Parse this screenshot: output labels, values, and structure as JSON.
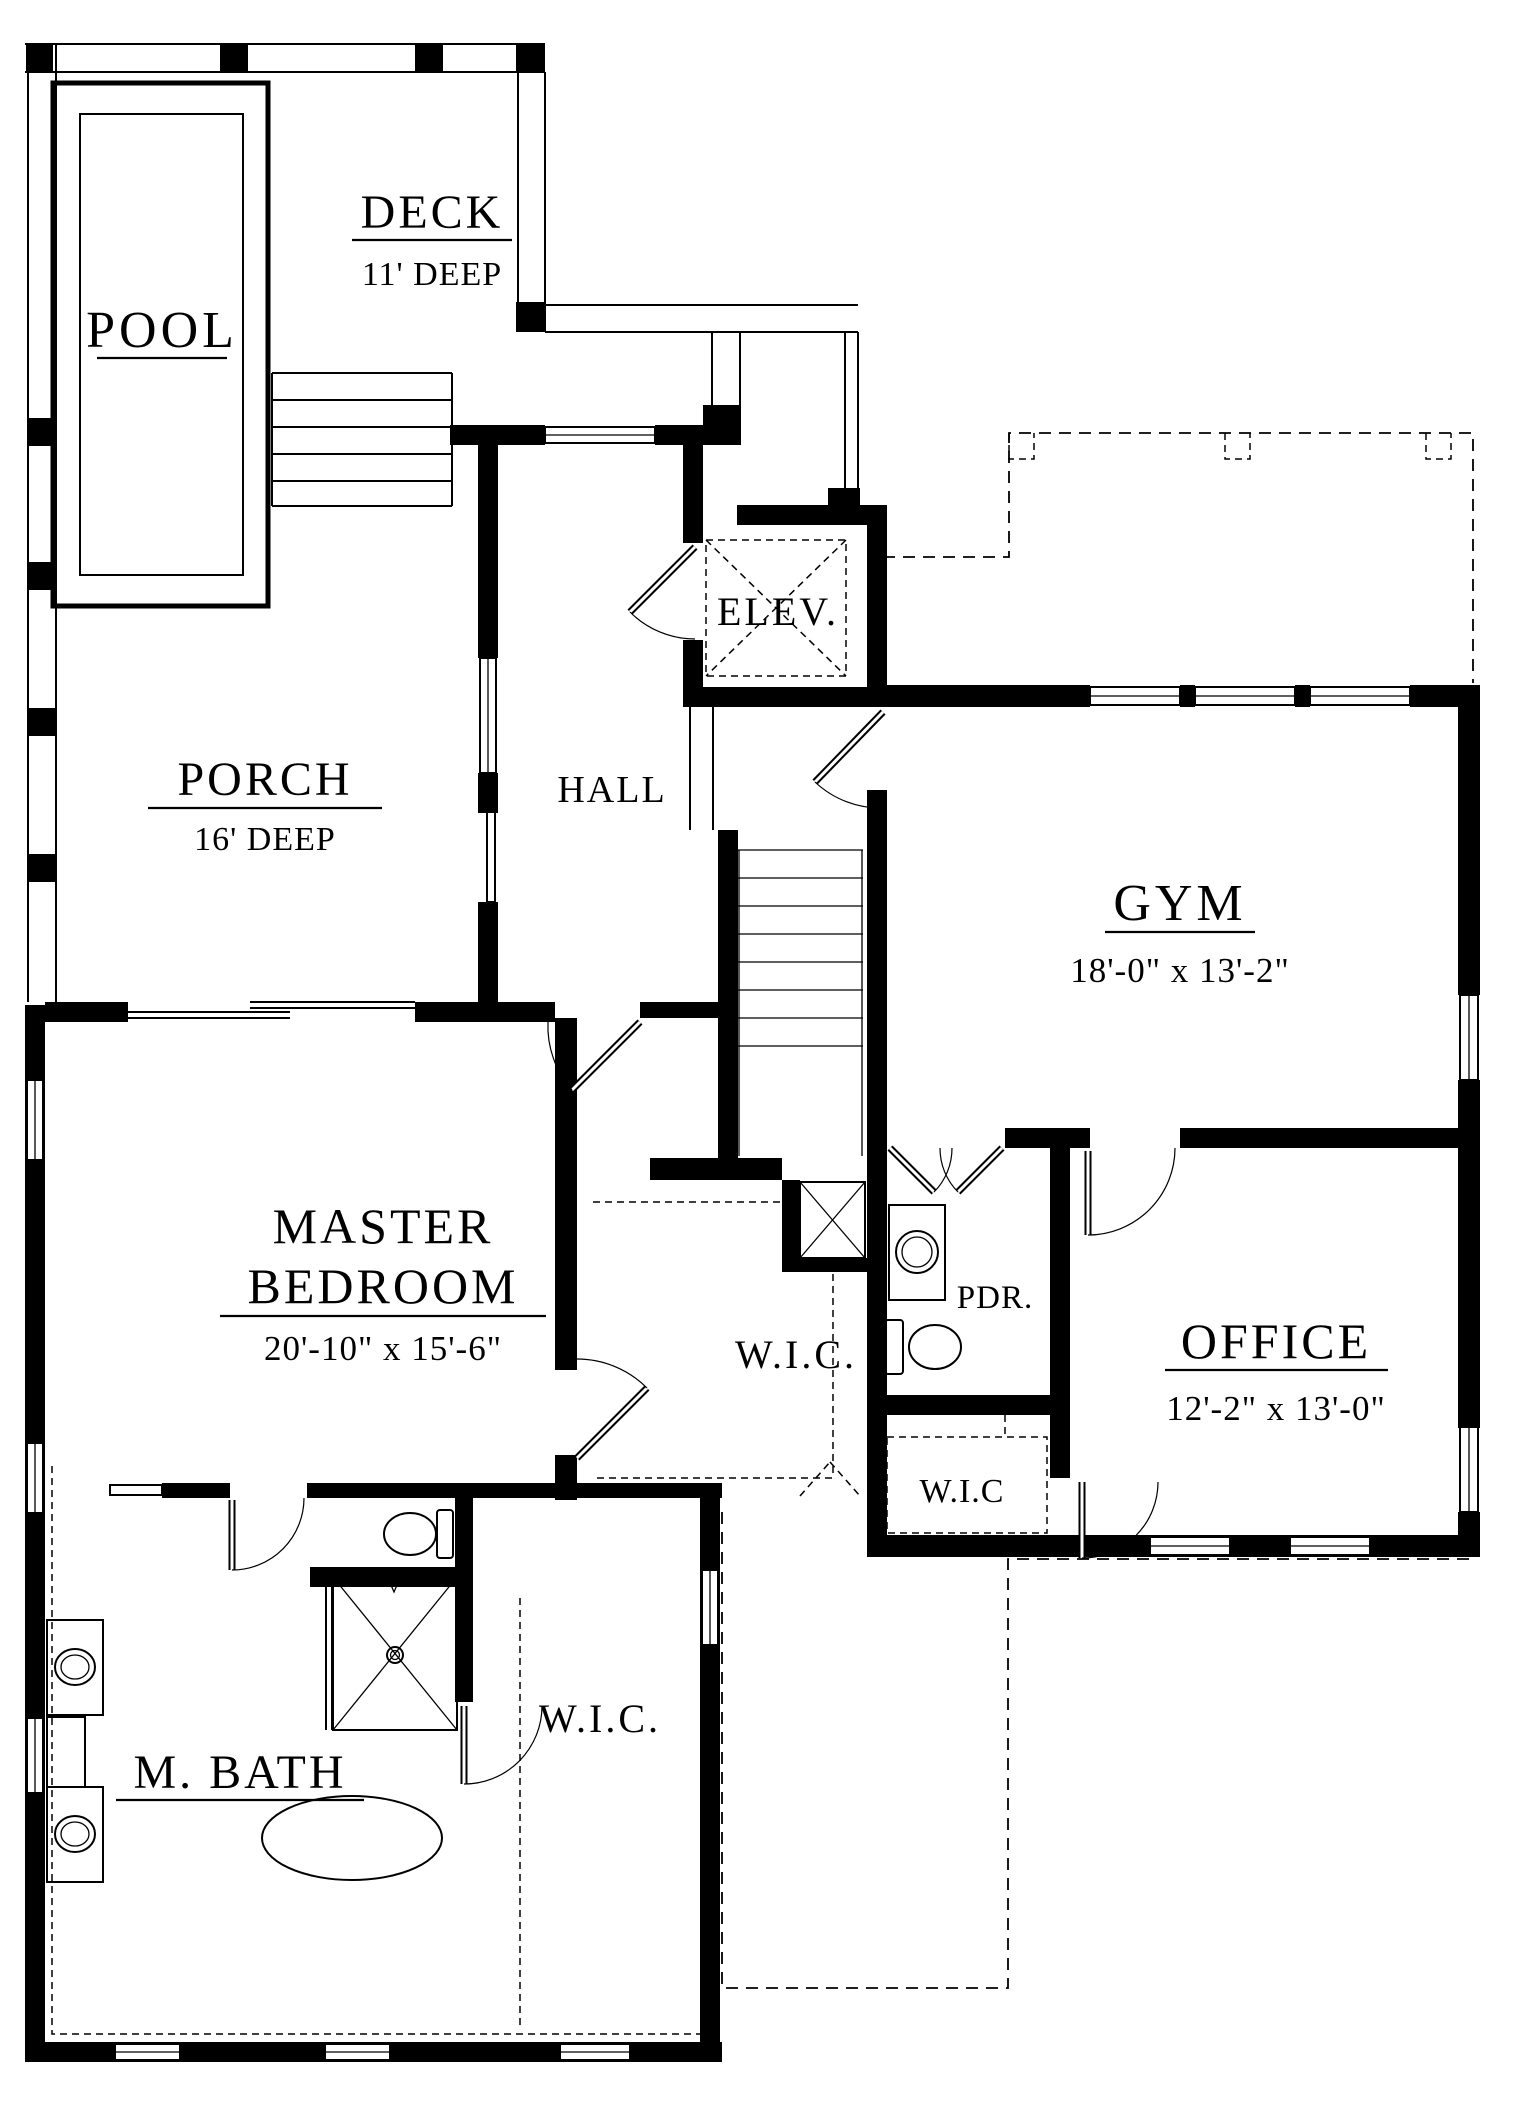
{
  "plan": {
    "colors": {
      "ink": "#000000",
      "paper": "#ffffff"
    },
    "rooms": {
      "pool": {
        "label": "POOL"
      },
      "deck": {
        "label": "DECK",
        "depth": "11' DEEP"
      },
      "porch": {
        "label": "PORCH",
        "depth": "16' DEEP"
      },
      "hall": {
        "label": "HALL"
      },
      "elevator": {
        "label": "ELEV."
      },
      "gym": {
        "label": "GYM",
        "dims": "18'-0\" x 13'-2\""
      },
      "master_bedroom": {
        "label_line1": "MASTER",
        "label_line2": "BEDROOM",
        "dims": "20'-10\" x 15'-6\""
      },
      "master_wic": {
        "label": "W.I.C."
      },
      "powder": {
        "label": "PDR."
      },
      "office": {
        "label": "OFFICE",
        "dims": "12'-2\" x 13'-0\""
      },
      "office_wic": {
        "label": "W.I.C"
      },
      "master_bath": {
        "label": "M. BATH"
      },
      "bath_wic": {
        "label": "W.I.C."
      }
    }
  }
}
